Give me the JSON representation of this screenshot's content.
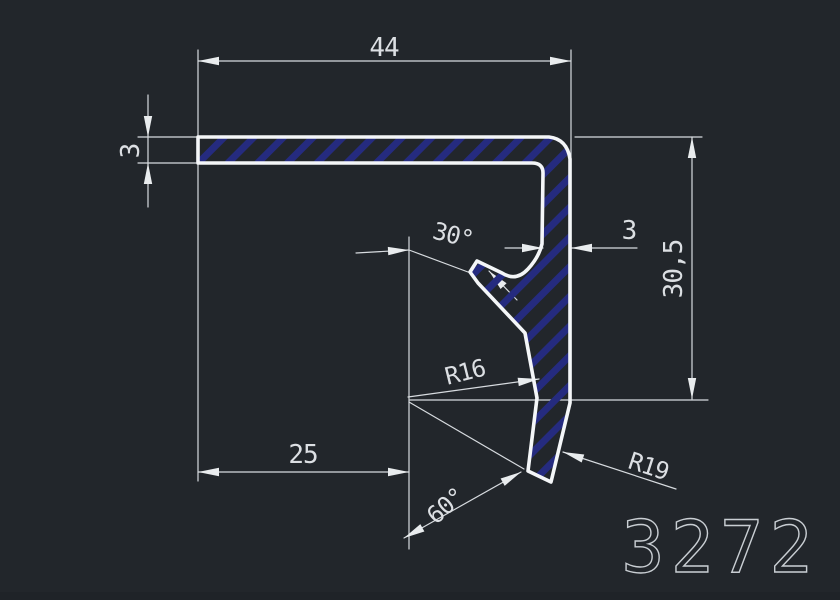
{
  "drawing": {
    "number": "3272",
    "type": "aluminium-profile-cross-section"
  },
  "labels": {
    "flange_width": "44",
    "flange_thickness": "3",
    "wall_thickness": "3",
    "overall_height": "30,5",
    "base_width": "25",
    "hook_angle": "30°",
    "bend_radius": "R16",
    "tip_radius": "R19",
    "tip_angle": "60°"
  },
  "colors": {
    "background": "#22262b",
    "profile_outline": "#f4f6f8",
    "hatch_blue": "#252b7f",
    "dimension_gray": "#d7dbdf",
    "drawing_number_gray": "#c9ced3"
  }
}
